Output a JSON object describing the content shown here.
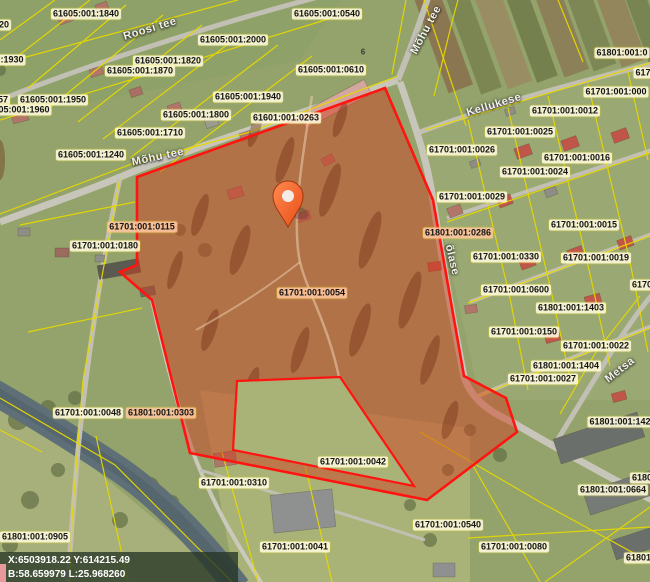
{
  "map": {
    "title": "Cadastral map with selected parcel",
    "colors": {
      "selection_fill": "#d23c1e",
      "selection_stroke": "#ff1410",
      "parcel_line": "#e6d800",
      "label_bg": "rgba(255,251,220,0.88)",
      "label_bg_highlight": "rgba(255,198,158,0.88)",
      "pin": "#f4511e",
      "water": "#5f6f77",
      "road": "#c2c0b4",
      "coord_text": "#ffffff"
    },
    "selected_parcel": {
      "code": "61701:001:0054"
    },
    "coordinate_readout": {
      "line1": "X:6503918.22 Y:614215.49",
      "line2": "B:58.659979 L:25.968260"
    },
    "marker": {
      "name": "location-pin",
      "x": 288,
      "y": 227
    },
    "cadastral_labels": [
      {
        "text": "61605:001:1840",
        "x": 86,
        "y": 14
      },
      {
        "text": "20",
        "x": 4,
        "y": 25,
        "partial": true
      },
      {
        "text": "61605:001:0540",
        "x": 327,
        "y": 14
      },
      {
        "text": "61605:001:2000",
        "x": 233,
        "y": 40
      },
      {
        "text": "61605:001:1820",
        "x": 168,
        "y": 61
      },
      {
        "text": "61605:001:1870",
        "x": 140,
        "y": 71
      },
      {
        "text": ":1930",
        "x": 12,
        "y": 60,
        "partial": true
      },
      {
        "text": "61605:001:0610",
        "x": 331,
        "y": 70
      },
      {
        "text": "61605:001:1940",
        "x": 248,
        "y": 97
      },
      {
        "text": "57",
        "x": 3,
        "y": 100,
        "partial": true
      },
      {
        "text": "61605:001:1950",
        "x": 53,
        "y": 100
      },
      {
        "text": "05:001:1960",
        "x": 24,
        "y": 110,
        "partial": true
      },
      {
        "text": "61605:001:1800",
        "x": 196,
        "y": 115
      },
      {
        "text": "61601:001:0263",
        "x": 286,
        "y": 118
      },
      {
        "text": "61605:001:1710",
        "x": 150,
        "y": 133
      },
      {
        "text": "61605:001:1240",
        "x": 91,
        "y": 155
      },
      {
        "text": "61801:001:0",
        "x": 622,
        "y": 53,
        "partial": true
      },
      {
        "text": "617",
        "x": 643,
        "y": 73,
        "partial": true
      },
      {
        "text": "61701:001:000",
        "x": 616,
        "y": 92,
        "partial": true
      },
      {
        "text": "61701:001:0012",
        "x": 565,
        "y": 111
      },
      {
        "text": "61701:001:0025",
        "x": 520,
        "y": 132
      },
      {
        "text": "61701:001:0026",
        "x": 462,
        "y": 150
      },
      {
        "text": "61701:001:0016",
        "x": 577,
        "y": 158
      },
      {
        "text": "61701:001:0024",
        "x": 535,
        "y": 172
      },
      {
        "text": "61701:001:0029",
        "x": 472,
        "y": 197
      },
      {
        "text": "61701:001:0015",
        "x": 584,
        "y": 225
      },
      {
        "text": "61701:001:0115",
        "x": 142,
        "y": 227,
        "highlight": true
      },
      {
        "text": "61801:001:0286",
        "x": 458,
        "y": 233,
        "highlight": true
      },
      {
        "text": "61701:001:0180",
        "x": 105,
        "y": 246
      },
      {
        "text": "61701:001:0330",
        "x": 506,
        "y": 257
      },
      {
        "text": "61701:001:0019",
        "x": 596,
        "y": 258
      },
      {
        "text": "6170",
        "x": 642,
        "y": 285,
        "partial": true
      },
      {
        "text": "61701:001:0600",
        "x": 516,
        "y": 290
      },
      {
        "text": "61701:001:0054",
        "x": 312,
        "y": 293,
        "highlight": true
      },
      {
        "text": "61801:001:1403",
        "x": 571,
        "y": 308
      },
      {
        "text": "61701:001:0150",
        "x": 524,
        "y": 332
      },
      {
        "text": "61701:001:0022",
        "x": 596,
        "y": 346
      },
      {
        "text": "61801:001:1404",
        "x": 566,
        "y": 366
      },
      {
        "text": "61701:001:0027",
        "x": 543,
        "y": 379
      },
      {
        "text": "61701:001:0048",
        "x": 88,
        "y": 413
      },
      {
        "text": "61801:001:0303",
        "x": 161,
        "y": 413,
        "highlight": true
      },
      {
        "text": "61801:001:142",
        "x": 620,
        "y": 422,
        "partial": true
      },
      {
        "text": "61701:001:0042",
        "x": 353,
        "y": 462
      },
      {
        "text": "6180",
        "x": 642,
        "y": 478,
        "partial": true
      },
      {
        "text": "61701:001:0310",
        "x": 234,
        "y": 483
      },
      {
        "text": "61801:001:0664",
        "x": 613,
        "y": 490
      },
      {
        "text": "61701:001:0540",
        "x": 448,
        "y": 525
      },
      {
        "text": "61801:001:0905",
        "x": 35,
        "y": 537
      },
      {
        "text": "61701:001:0041",
        "x": 295,
        "y": 547
      },
      {
        "text": "61701:001:0080",
        "x": 514,
        "y": 547
      },
      {
        "text": "61801:",
        "x": 640,
        "y": 558,
        "partial": true
      }
    ],
    "street_labels": [
      {
        "text": "Roosi tee",
        "x": 150,
        "y": 29,
        "rot": -17
      },
      {
        "text": "Mõhu tee",
        "x": 426,
        "y": 30,
        "rot": -62
      },
      {
        "text": "Kellukese",
        "x": 494,
        "y": 105,
        "rot": -17
      },
      {
        "text": "Mõhu tee",
        "x": 158,
        "y": 157,
        "rot": -12
      },
      {
        "text": "õlase",
        "x": 452,
        "y": 260,
        "rot": 77,
        "partial": true
      },
      {
        "text": "Metsa",
        "x": 620,
        "y": 370,
        "rot": -38
      }
    ],
    "house_number_labels": [
      {
        "text": "6",
        "x": 363,
        "y": 52
      }
    ]
  }
}
